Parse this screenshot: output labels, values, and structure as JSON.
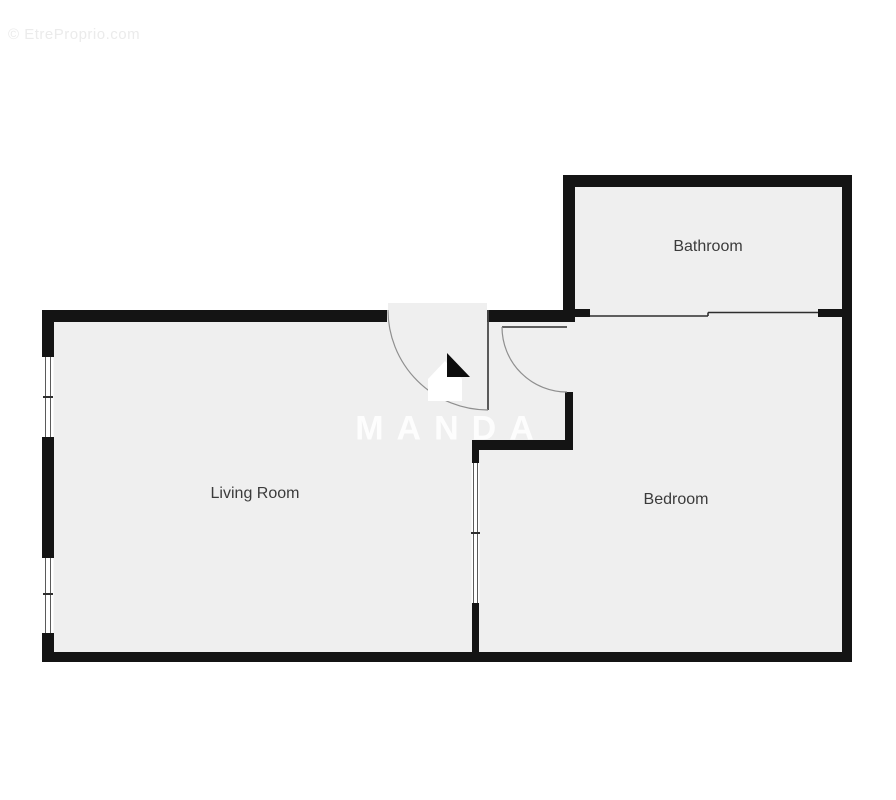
{
  "watermark": {
    "text": "© EtreProprio.com"
  },
  "brand": {
    "text": "MANDA",
    "logo_icon": "home-logo"
  },
  "rooms": {
    "bathroom": {
      "label": "Bathroom"
    },
    "living_room": {
      "label": "Living Room"
    },
    "bedroom": {
      "label": "Bedroom"
    }
  },
  "colors": {
    "background": "#ffffff",
    "wall": "#141414",
    "room_fill": "#efefef",
    "label_text": "#3b3b3b",
    "door_arc": "#8f8f8f",
    "thin_partition": "#2e2e2e",
    "copyright_watermark": "#ebebeb",
    "brand_watermark": "rgba(255,255,255,0.88)"
  }
}
